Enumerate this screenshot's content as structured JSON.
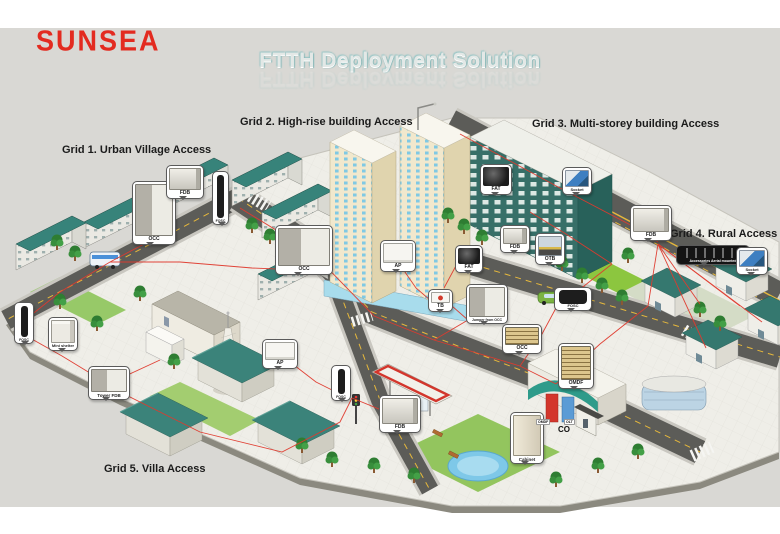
{
  "logo": {
    "text": "SUNSEA",
    "color": "#e32b20"
  },
  "title": {
    "text": "FTTH Deployment Solution"
  },
  "grid_labels": [
    {
      "id": "grid1",
      "text": "Grid 1. Urban Village Access",
      "x": 62,
      "y": 144
    },
    {
      "id": "grid2",
      "text": "Grid 2. High-rise building Access",
      "x": 240,
      "y": 116
    },
    {
      "id": "grid3",
      "text": "Grid 3. Multi-storey building Access",
      "x": 532,
      "y": 118
    },
    {
      "id": "grid4",
      "text": "Grid 4. Rural Access",
      "x": 670,
      "y": 228
    },
    {
      "id": "grid5",
      "text": "Grid 5. Villa Access",
      "x": 104,
      "y": 463
    }
  ],
  "callouts": [
    {
      "id": "occ-1",
      "label": "OCC",
      "x": 132,
      "y": 181,
      "w": 44,
      "h": 64,
      "type": "cabinet-open",
      "fs": 5
    },
    {
      "id": "fdb-1",
      "label": "FDB",
      "x": 166,
      "y": 165,
      "w": 38,
      "h": 34,
      "type": "cabinet-wall",
      "fs": 5
    },
    {
      "id": "fosc-1",
      "label": "FOSC",
      "x": 212,
      "y": 171,
      "w": 17,
      "h": 54,
      "type": "cyl-v",
      "fs": 3.5
    },
    {
      "id": "occ-2",
      "label": "OCC",
      "x": 275,
      "y": 225,
      "w": 58,
      "h": 50,
      "type": "cabinet-open",
      "fs": 5
    },
    {
      "id": "ap-1",
      "label": "AP",
      "x": 380,
      "y": 240,
      "w": 36,
      "h": 32,
      "type": "box-white",
      "fs": 5
    },
    {
      "id": "fat-1",
      "label": "FAT",
      "x": 455,
      "y": 245,
      "w": 28,
      "h": 28,
      "type": "dev-dark",
      "fs": 5
    },
    {
      "id": "tb-1",
      "label": "TB",
      "x": 428,
      "y": 289,
      "w": 25,
      "h": 23,
      "type": "tb",
      "fs": 5
    },
    {
      "id": "jumper-1",
      "label": "Jumper from OCC",
      "x": 466,
      "y": 284,
      "w": 42,
      "h": 40,
      "type": "cabinet-open",
      "fs": 3.5
    },
    {
      "id": "fdb-2",
      "label": "FDB",
      "x": 500,
      "y": 225,
      "w": 30,
      "h": 28,
      "type": "cabinet-wall",
      "fs": 5
    },
    {
      "id": "otb-1",
      "label": "OTB",
      "x": 535,
      "y": 233,
      "w": 30,
      "h": 32,
      "type": "otb",
      "fs": 5
    },
    {
      "id": "fosc-2",
      "label": "FOSC",
      "x": 554,
      "y": 287,
      "w": 38,
      "h": 24,
      "type": "cyl-h",
      "fs": 4
    },
    {
      "id": "fat-2",
      "label": "FAT",
      "x": 480,
      "y": 164,
      "w": 32,
      "h": 31,
      "type": "dev-dark",
      "fs": 5
    },
    {
      "id": "socket-1",
      "label": "Socket",
      "x": 562,
      "y": 167,
      "w": 30,
      "h": 28,
      "type": "socket",
      "fs": 4
    },
    {
      "id": "fdb-3",
      "label": "FDB",
      "x": 630,
      "y": 205,
      "w": 42,
      "h": 36,
      "type": "cabinet-wall",
      "fs": 5
    },
    {
      "id": "aerial-1",
      "label": "Accessories Aerial mounted",
      "x": 676,
      "y": 245,
      "w": 74,
      "h": 20,
      "type": "strip",
      "fs": 3.5
    },
    {
      "id": "socket-2",
      "label": "Socket",
      "x": 736,
      "y": 247,
      "w": 32,
      "h": 28,
      "type": "socket",
      "fs": 4
    },
    {
      "id": "fosc-3",
      "label": "FOSC",
      "x": 14,
      "y": 302,
      "w": 20,
      "h": 42,
      "type": "cyl-v",
      "fs": 3.5
    },
    {
      "id": "mini-shelter",
      "label": "Mini shelter",
      "x": 48,
      "y": 317,
      "w": 30,
      "h": 34,
      "type": "shelter",
      "fs": 4
    },
    {
      "id": "tower-fdb",
      "label": "Tower FDB",
      "x": 88,
      "y": 366,
      "w": 42,
      "h": 34,
      "type": "cabinet-open",
      "fs": 4.5
    },
    {
      "id": "ap-2",
      "label": "AP",
      "x": 262,
      "y": 339,
      "w": 36,
      "h": 30,
      "type": "box-white",
      "fs": 5
    },
    {
      "id": "fosc-4",
      "label": "FOSC",
      "x": 331,
      "y": 365,
      "w": 20,
      "h": 36,
      "type": "cyl-v",
      "fs": 3.5
    },
    {
      "id": "fdb-4",
      "label": "FDB",
      "x": 379,
      "y": 395,
      "w": 42,
      "h": 38,
      "type": "cabinet-wall",
      "fs": 5
    },
    {
      "id": "occ-3",
      "label": "OCC",
      "x": 502,
      "y": 324,
      "w": 40,
      "h": 30,
      "type": "rack",
      "fs": 5
    },
    {
      "id": "omdf-1",
      "label": "OMDF",
      "x": 558,
      "y": 343,
      "w": 36,
      "h": 46,
      "type": "rack",
      "fs": 5
    },
    {
      "id": "cabinet-1",
      "label": "Cabinet",
      "x": 510,
      "y": 412,
      "w": 34,
      "h": 52,
      "type": "door",
      "fs": 4.5
    }
  ],
  "scene_labels": [
    {
      "id": "co",
      "text": "CO",
      "x": 558,
      "y": 425,
      "size": 8,
      "chip": false
    },
    {
      "id": "omdf",
      "text": "OMDF",
      "x": 536,
      "y": 419,
      "size": 3.5,
      "chip": true
    },
    {
      "id": "olt",
      "text": "OLT",
      "x": 564,
      "y": 419,
      "size": 3.5,
      "chip": true
    }
  ],
  "colors": {
    "panel_bg": "#d9d8d4",
    "accent_red": "#e32b20",
    "fiber_red": "#e03a2e",
    "roof_teal": "#35786f",
    "asphalt": "#5c5c58",
    "grass": "#8cc63f",
    "highrise_wall": "#f1e8cd",
    "title_teal_glow": "#7fb5b5"
  }
}
